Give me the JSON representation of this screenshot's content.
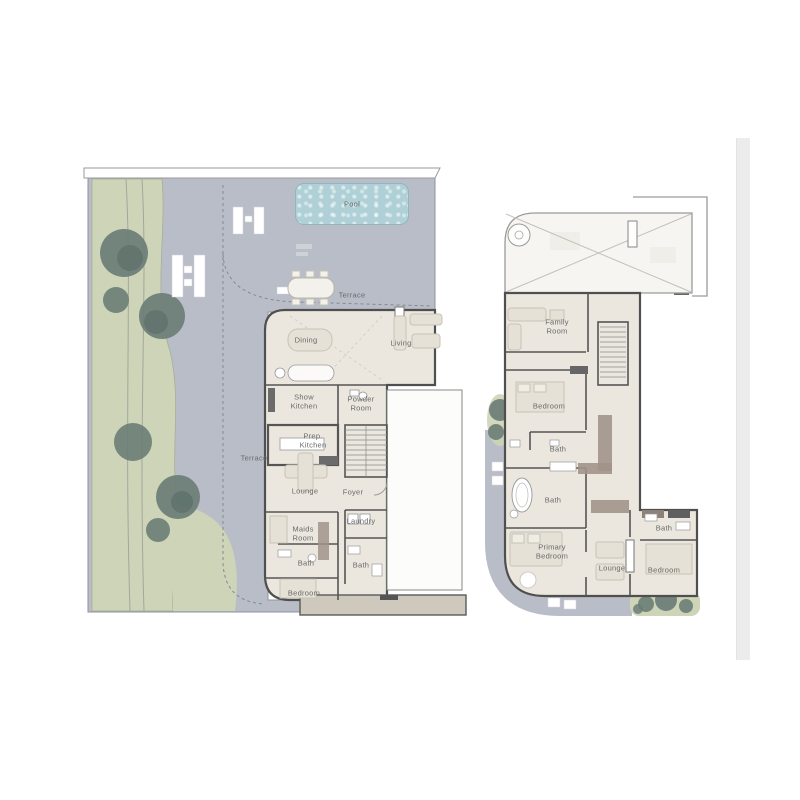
{
  "window": {
    "background": "#ffffff"
  },
  "colors": {
    "site_gray": "#b9bdc8",
    "landscape_green": "#ced4b8",
    "tree_green": "#6b7d76",
    "tree_shade": "#50645d",
    "floor_cream": "#ebe7df",
    "wall_dark": "#4f4f4f",
    "pool_blue": "#aed0d6",
    "pool_border": "#92b6bd",
    "wardrobe_brown": "#a2938a",
    "band_beige": "#cfc8bd",
    "void_fill": "#f6f5f1",
    "outline_gray": "#9a9a9a",
    "label_gray": "#6a6a6a",
    "scrollbar_gray": "#ececec",
    "furniture_light": "#e5e1d6",
    "furniture_stroke": "#c7c3b6"
  },
  "ground_floor": {
    "labels": {
      "pool": "Pool",
      "terrace_outdoor": "Terrace",
      "dining": "Dining",
      "living": "Living",
      "show_kitchen": "Show\nKitchen",
      "powder_room": "Powder\nRoom",
      "prep_kitchen": "Prep.\nKitchen",
      "terrace_side": "Terrace",
      "lounge": "Lounge",
      "foyer": "Foyer",
      "maids_room": "Maids\nRoom",
      "laundry": "Laundry",
      "bath_1": "Bath",
      "bath_2": "Bath",
      "bedroom": "Bedroom"
    }
  },
  "first_floor": {
    "labels": {
      "family_room": "Family\nRoom",
      "bedroom_1": "Bedroom",
      "bath_1": "Bath",
      "bath_2": "Bath",
      "primary_bedroom": "Primary\nBedroom",
      "lounge": "Lounge",
      "bath_3": "Bath",
      "bedroom_2": "Bedroom"
    }
  }
}
